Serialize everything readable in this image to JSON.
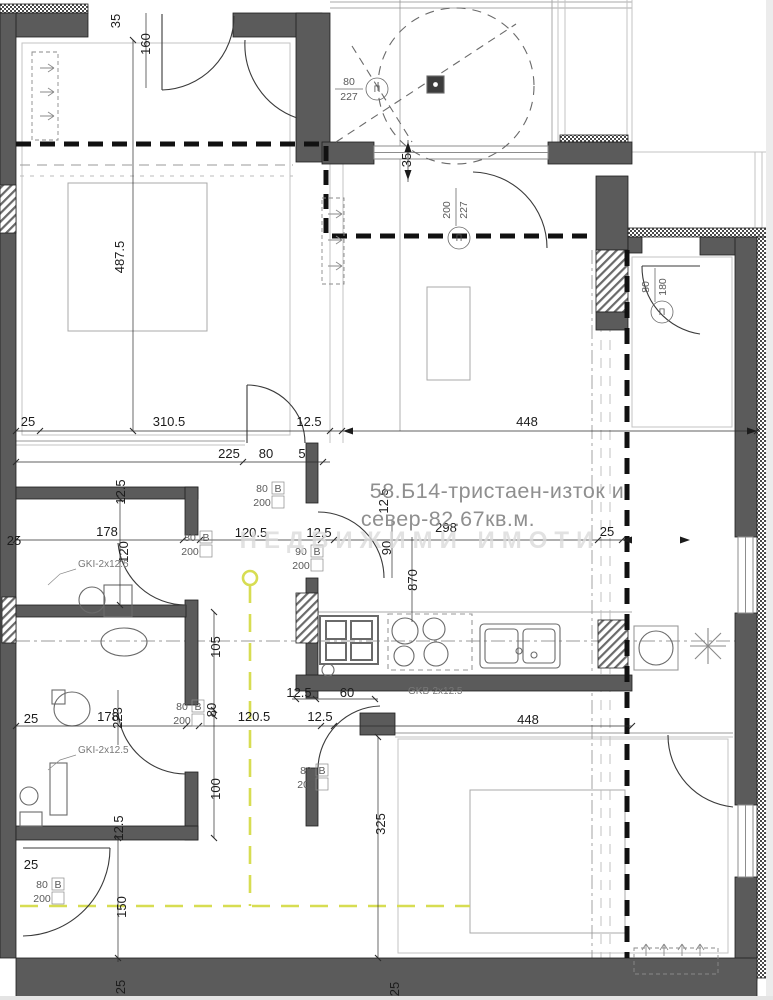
{
  "plan": {
    "title_line1": "58.Б14-тристаен-изток и",
    "title_line2": "север-82.67кв.м.",
    "watermark": "НЕДВИЖИМИ ИМОТИ",
    "marker_glyph": "П",
    "colors": {
      "wall": "#5b5b5b",
      "wall_edge": "#1f1f1f",
      "boundary_dash": "#111111",
      "accent_yellow": "#d7dd52",
      "thin_line": "#9a9a9a",
      "title_gray": "#8f8f8f"
    },
    "dims": [
      {
        "t": "35"
      },
      {
        "t": "160"
      },
      {
        "t": "487.5"
      },
      {
        "t": "35"
      },
      {
        "t": "25"
      },
      {
        "t": "310.5"
      },
      {
        "t": "12.5"
      },
      {
        "t": "448"
      },
      {
        "t": "225"
      },
      {
        "t": "80"
      },
      {
        "t": "5"
      },
      {
        "t": "12.5"
      },
      {
        "t": "12.5"
      },
      {
        "t": "25"
      },
      {
        "t": "178"
      },
      {
        "t": "120.5"
      },
      {
        "t": "12.5"
      },
      {
        "t": "298"
      },
      {
        "t": "25"
      },
      {
        "t": "120"
      },
      {
        "t": "90"
      },
      {
        "t": "870"
      },
      {
        "t": "105"
      },
      {
        "t": "12.5"
      },
      {
        "t": "60"
      },
      {
        "t": "80"
      },
      {
        "t": "178"
      },
      {
        "t": "223"
      },
      {
        "t": "120.5"
      },
      {
        "t": "12.5"
      },
      {
        "t": "448"
      },
      {
        "t": "25"
      },
      {
        "t": "100"
      },
      {
        "t": "12.5"
      },
      {
        "t": "25"
      },
      {
        "t": "325"
      },
      {
        "t": "150"
      },
      {
        "t": "25"
      },
      {
        "t": "25"
      }
    ],
    "fraction_tags": [
      {
        "top": "80",
        "bottom": "227"
      },
      {
        "top": "200",
        "bottom": "227"
      },
      {
        "top": "80",
        "bottom": "180"
      }
    ],
    "boxed_tags": [
      {
        "w": "80",
        "code": "В",
        "h": "200"
      },
      {
        "w": "80",
        "code": "В",
        "h": "200"
      },
      {
        "w": "90",
        "code": "В",
        "h": "200"
      },
      {
        "w": "80",
        "code": "В",
        "h": "200"
      },
      {
        "w": "80",
        "code": "В",
        "h": "200"
      },
      {
        "w": "80",
        "code": "В",
        "h": "200"
      }
    ],
    "material_labels": [
      "GKI-2x12.5",
      "GKI-2x12.5",
      "GKB-2x12.5"
    ]
  }
}
